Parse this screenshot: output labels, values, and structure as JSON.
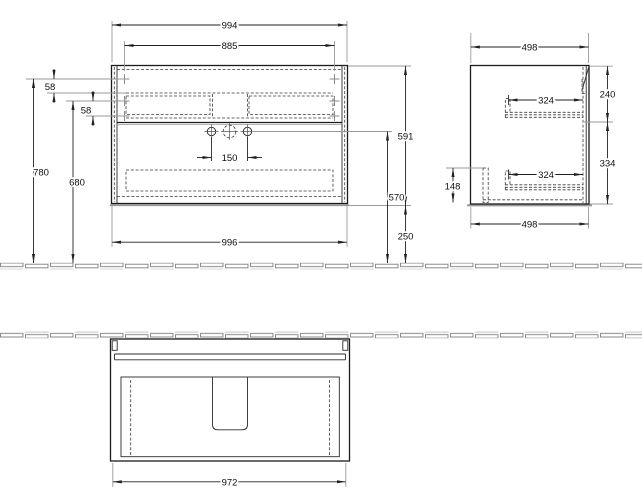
{
  "drawing": {
    "description": "Technical dimension drawing of a wall-mounted vanity unit: front elevation, side elevation and bottom view, with tiled wall/floor strips",
    "units": "mm",
    "colors": {
      "outline": "#1b1b1b",
      "dimension_lines": "#222222",
      "extension_lines": "#9a9a9a",
      "hidden_lines": "#3a3a3a",
      "text": "#111111",
      "background": "#ffffff"
    },
    "front_view": {
      "overall_width": "994",
      "mounting_width": "885",
      "hole_offset_upper": "58",
      "hole_offset_lower": "58",
      "mount_height_upper": "780",
      "mount_height_lower": "680",
      "tap_spacing": "150",
      "carcass_width": "996",
      "tap_height": "570",
      "body_height": "591",
      "floor_clearance": "250"
    },
    "side_view": {
      "depth_top": "498",
      "runner_upper": "324",
      "section_upper": "240",
      "runner_lower": "324",
      "section_lower": "334",
      "recess_height": "148",
      "depth_bottom": "498"
    },
    "bottom_view": {
      "carcass_width": "972"
    }
  }
}
